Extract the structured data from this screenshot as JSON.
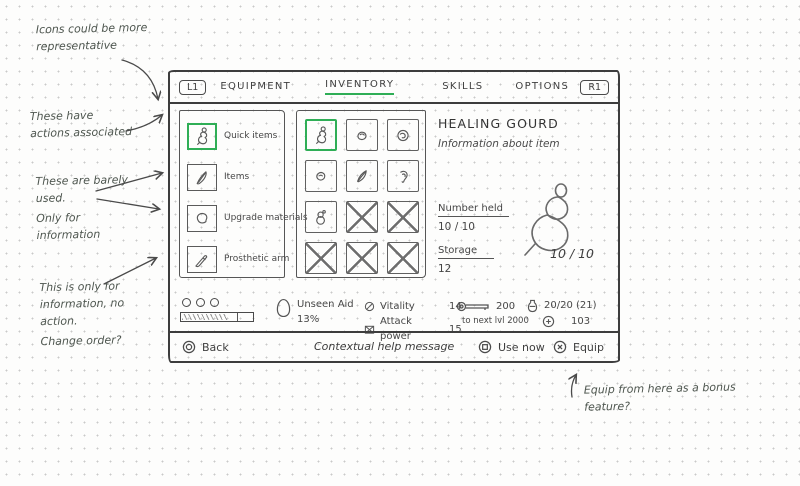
{
  "colors": {
    "accent_green": "#2fae56",
    "ink": "#454545"
  },
  "annotations": {
    "icons_note": "Icons could be more representative",
    "actions_note": "These have actions associated",
    "barely_used_note": "These are barely used.",
    "only_info_note": "Only for information",
    "info_only_note": "This is only for information, no action.",
    "change_order_note": "Change order?",
    "equip_bonus_note": "Equip from here as a bonus feature?"
  },
  "header": {
    "left_shoulder": "L1",
    "right_shoulder": "R1",
    "tabs": [
      {
        "label": "EQUIPMENT"
      },
      {
        "label": "INVENTORY"
      },
      {
        "label": "SKILLS"
      },
      {
        "label": "OPTIONS"
      }
    ]
  },
  "sidebar": {
    "items": [
      {
        "label": "Quick items",
        "icon": "gourd",
        "selected": true
      },
      {
        "label": "Items",
        "icon": "knife",
        "selected": false
      },
      {
        "label": "Upgrade materials",
        "icon": "material",
        "selected": false
      },
      {
        "label": "Prosthetic arm",
        "icon": "arm",
        "selected": false
      }
    ]
  },
  "grid": {
    "cells": [
      {
        "type": "gourd",
        "selected": true
      },
      {
        "type": "pellet"
      },
      {
        "type": "round"
      },
      {
        "type": "seed"
      },
      {
        "type": "feather"
      },
      {
        "type": "ear"
      },
      {
        "type": "snowman"
      },
      {
        "type": "empty"
      },
      {
        "type": "empty"
      },
      {
        "type": "empty"
      },
      {
        "type": "empty"
      },
      {
        "type": "empty"
      }
    ]
  },
  "detail": {
    "title": "HEALING GOURD",
    "subtitle": "Information about item",
    "number_held_label": "Number held",
    "number_held_value": "10 / 10",
    "storage_label": "Storage",
    "storage_value": "12",
    "preview_count": "10 / 10"
  },
  "status": {
    "unseen_aid_label": "Unseen Aid",
    "unseen_aid_value": "13%",
    "vitality_label": "Vitality",
    "vitality_value": "14",
    "attack_label": "Attack power",
    "attack_value": "15",
    "xp_value": "200",
    "xp_next_label": "to next lvl 2000",
    "emblems_value": "20/20 (21)",
    "sen_value": "103"
  },
  "footer": {
    "back_label": "Back",
    "help_message": "Contextual help message",
    "use_label": "Use now",
    "equip_label": "Equip"
  }
}
